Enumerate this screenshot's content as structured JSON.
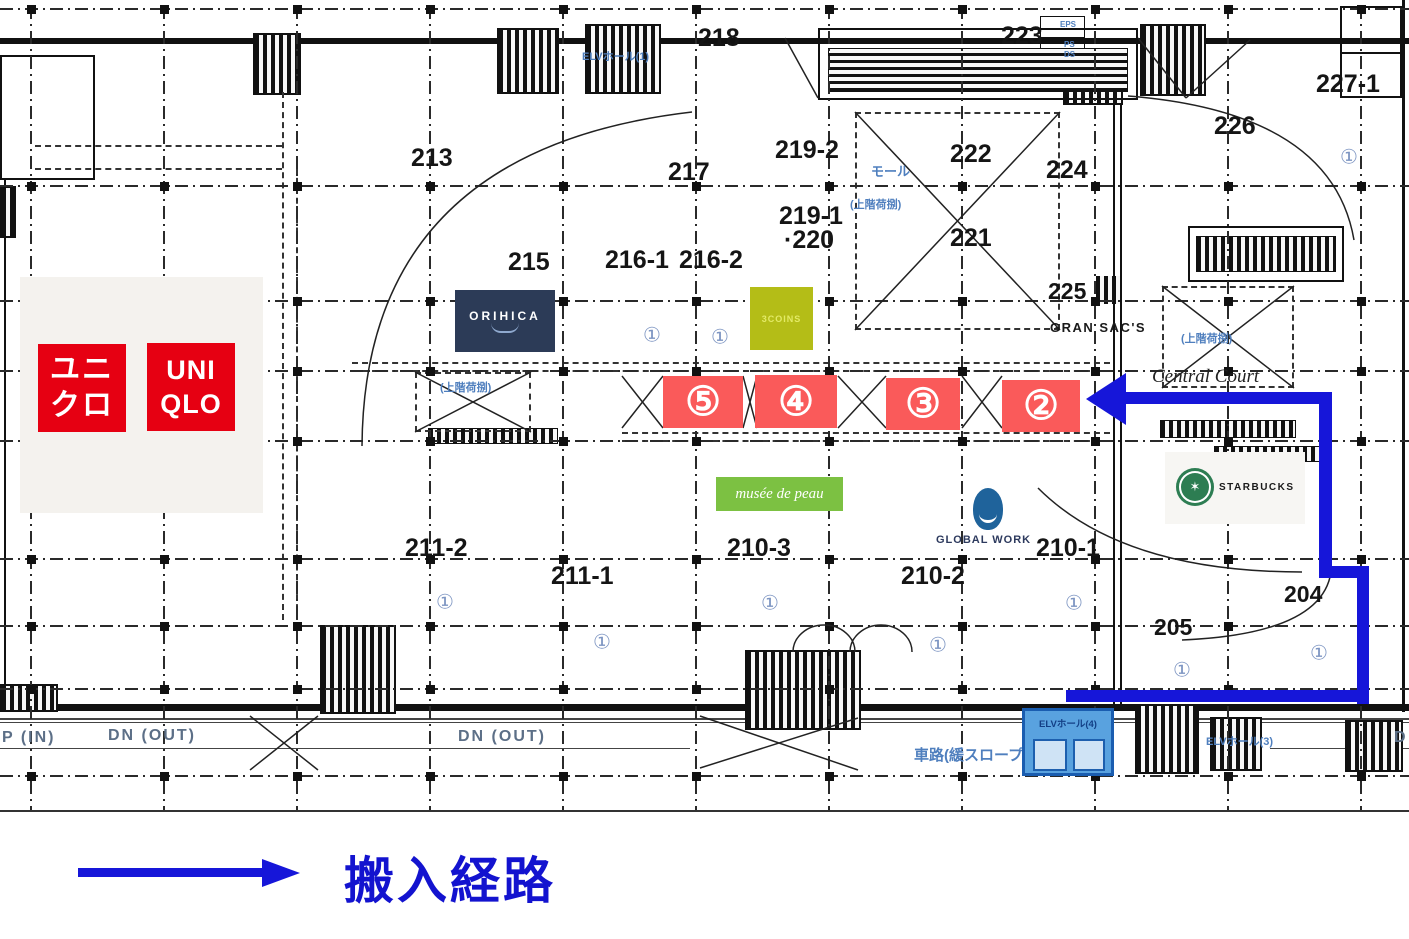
{
  "legend": {
    "label": "搬入経路"
  },
  "uniqlo": {
    "jp_top": "ユニ",
    "jp_bottom": "クロ",
    "en_top": "UNI",
    "en_bottom": "QLO"
  },
  "logos": {
    "orihica": "ORIHICA",
    "coins": "3COINS",
    "musee": "musée de peau",
    "global_work": "GLOBAL WORK",
    "starbucks": "STARBUCKS",
    "gran_sacs": "GRAN SAC'S",
    "central_court": "Central Court"
  },
  "elevator_box": {
    "label": "ELVホール(4)"
  },
  "rooms": [
    {
      "label": "218",
      "x": 698,
      "y": 24
    },
    {
      "label": "223",
      "x": 1001,
      "y": 22
    },
    {
      "label": "227-1",
      "x": 1316,
      "y": 70
    },
    {
      "label": "226",
      "x": 1214,
      "y": 112
    },
    {
      "label": "213",
      "x": 411,
      "y": 144
    },
    {
      "label": "217",
      "x": 668,
      "y": 158
    },
    {
      "label": "219-2",
      "x": 775,
      "y": 136
    },
    {
      "label": "222",
      "x": 950,
      "y": 140
    },
    {
      "label": "224",
      "x": 1046,
      "y": 156
    },
    {
      "label": "221",
      "x": 950,
      "y": 224
    },
    {
      "label": "219-1",
      "x": 779,
      "y": 202
    },
    {
      "label": "·220",
      "x": 784,
      "y": 226
    },
    {
      "label": "215",
      "x": 508,
      "y": 248
    },
    {
      "label": "216-1",
      "x": 605,
      "y": 246
    },
    {
      "label": "216-2",
      "x": 679,
      "y": 246
    },
    {
      "label": "225",
      "x": 1048,
      "y": 278,
      "fs": 23
    },
    {
      "label": "211-2",
      "x": 405,
      "y": 534
    },
    {
      "label": "211-1",
      "x": 551,
      "y": 562
    },
    {
      "label": "210-3",
      "x": 727,
      "y": 534
    },
    {
      "label": "210-2",
      "x": 901,
      "y": 562
    },
    {
      "label": "210-1",
      "x": 1036,
      "y": 534
    },
    {
      "label": "205",
      "x": 1154,
      "y": 614,
      "fs": 23
    },
    {
      "label": "204",
      "x": 1284,
      "y": 581,
      "fs": 23
    }
  ],
  "grey_labels": [
    {
      "label": "P (IN)",
      "x": 2,
      "y": 729
    },
    {
      "label": "DN (OUT)",
      "x": 108,
      "y": 727
    },
    {
      "label": "DN (OUT)",
      "x": 458,
      "y": 728
    },
    {
      "label": "D",
      "x": 1394,
      "y": 729
    }
  ],
  "blue_labels": [
    {
      "label": "ELVホール(1)",
      "x": 582,
      "y": 48,
      "fs": 11
    },
    {
      "label": "EPS",
      "x": 1060,
      "y": 20,
      "fs": 8
    },
    {
      "label": "PS",
      "x": 1064,
      "y": 40,
      "fs": 8
    },
    {
      "label": "DS",
      "x": 1064,
      "y": 50,
      "fs": 8
    },
    {
      "label": "モール",
      "x": 871,
      "y": 161,
      "fs": 13
    },
    {
      "label": "(上階荷捌)",
      "x": 850,
      "y": 196,
      "fs": 11
    },
    {
      "label": "(上階荷捌)",
      "x": 1181,
      "y": 330,
      "fs": 11
    },
    {
      "label": "(上階荷捌)",
      "x": 440,
      "y": 379,
      "fs": 11
    },
    {
      "label": "ELVホール(3)",
      "x": 1206,
      "y": 733,
      "fs": 11
    },
    {
      "label": "車路(緩スロープ)",
      "x": 914,
      "y": 744,
      "fs": 15
    }
  ],
  "circled_markers": {
    "glyph": "①",
    "positions": [
      [
        652,
        335
      ],
      [
        720,
        337
      ],
      [
        1349,
        157
      ],
      [
        445,
        602
      ],
      [
        602,
        642
      ],
      [
        770,
        603
      ],
      [
        938,
        645
      ],
      [
        1074,
        603
      ],
      [
        1182,
        670
      ],
      [
        1319,
        653
      ]
    ]
  },
  "badges": [
    {
      "label": "⑤",
      "x": 663,
      "y": 376,
      "w": 80,
      "h": 52
    },
    {
      "label": "④",
      "x": 755,
      "y": 375,
      "w": 82,
      "h": 53
    },
    {
      "label": "③",
      "x": 886,
      "y": 378,
      "w": 74,
      "h": 52
    },
    {
      "label": "②",
      "x": 1002,
      "y": 380,
      "w": 78,
      "h": 52
    }
  ],
  "colors": {
    "route_blue": "#1616d9",
    "badge_red": "#fa5a5a",
    "uniqlo_red": "#e60012",
    "orihica_navy": "#2c3b57",
    "coins_olive": "#b4bd17",
    "musee_green": "#7cc142",
    "global_work_blue": "#1f639b",
    "starbucks_green": "#2d7d52",
    "legend_blue": "#1313cf",
    "plan_annotation_blue": "#4f7fbe"
  }
}
